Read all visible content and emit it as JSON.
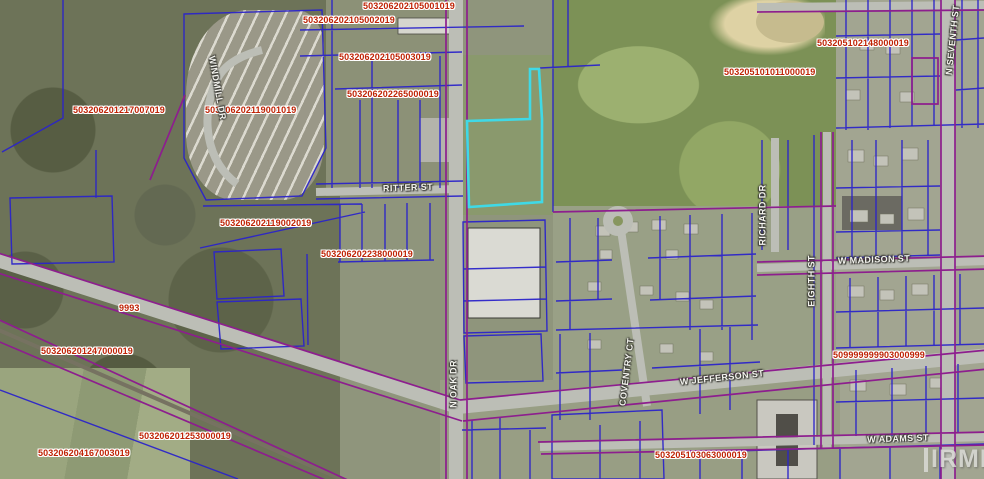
{
  "map": {
    "watermark": "IRMLS",
    "colors": {
      "parcel_line": "#2b24c9",
      "boundary_line": "#8d1e8e",
      "selected_parcel": "#3fd9e6",
      "parcel_label": "#bf2305",
      "street_label": "#f4f4ef",
      "road_fill": "#bcbeb6",
      "watermark_color": "#dadad6"
    },
    "labels": {
      "parcel_ids": [
        {
          "text": "503206202105001019",
          "x": 363,
          "y": 2
        },
        {
          "text": "503206202105002019",
          "x": 303,
          "y": 16
        },
        {
          "text": "503206202105003019",
          "x": 339,
          "y": 53
        },
        {
          "text": "503206202265000019",
          "x": 347,
          "y": 90
        },
        {
          "text": "503206201217007019",
          "x": 73,
          "y": 106
        },
        {
          "text": "503206202119001019",
          "x": 205,
          "y": 106
        },
        {
          "text": "503206202119002019",
          "x": 220,
          "y": 219
        },
        {
          "text": "503206202238000019",
          "x": 321,
          "y": 250
        },
        {
          "text": "503206201247000019",
          "x": 41,
          "y": 347
        },
        {
          "text": "503206201253000019",
          "x": 139,
          "y": 432
        },
        {
          "text": "503206204167003019",
          "x": 38,
          "y": 449
        },
        {
          "text": "503205102148000019",
          "x": 817,
          "y": 39
        },
        {
          "text": "503205101011000019",
          "x": 724,
          "y": 68
        },
        {
          "text": "509999999903000999",
          "x": 833,
          "y": 351
        },
        {
          "text": "503205103063000019",
          "x": 655,
          "y": 451
        }
      ],
      "streets": [
        {
          "text": "RITTER ST",
          "x": 408,
          "y": 188,
          "rot": -2
        },
        {
          "text": "WINDMILL DR",
          "x": 217,
          "y": 88,
          "rot": 80
        },
        {
          "text": "N OAK DR",
          "x": 454,
          "y": 384,
          "rot": -90
        },
        {
          "text": "COVENTRY CT",
          "x": 627,
          "y": 372,
          "rot": -83
        },
        {
          "text": "W JEFFERSON ST",
          "x": 722,
          "y": 378,
          "rot": -6
        },
        {
          "text": "W MADISON ST",
          "x": 874,
          "y": 260,
          "rot": -2
        },
        {
          "text": "W ADAMS ST",
          "x": 898,
          "y": 439,
          "rot": -2
        },
        {
          "text": "RICHARD DR",
          "x": 763,
          "y": 215,
          "rot": -90
        },
        {
          "text": "EIGHTH ST",
          "x": 812,
          "y": 281,
          "rot": -90
        },
        {
          "text": "N SEVENTH ST",
          "x": 953,
          "y": 40,
          "rot": -84
        }
      ],
      "addresses": [
        {
          "text": "9993",
          "x": 119,
          "y": 304
        }
      ]
    }
  }
}
